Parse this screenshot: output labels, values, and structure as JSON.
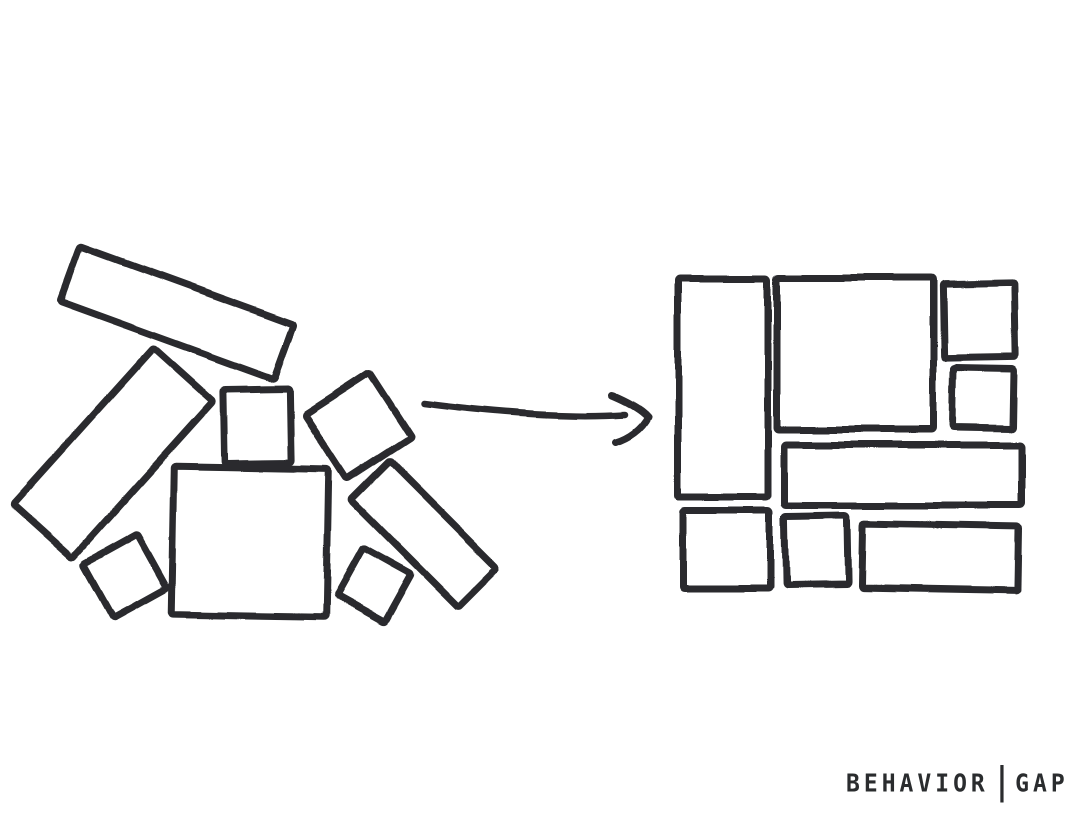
{
  "canvas": {
    "width": 1079,
    "height": 822,
    "background_color": "#ffffff",
    "ink_color": "#2a2c2e",
    "stroke_width": 7
  },
  "drawing": {
    "unorganized_pile": {
      "rectangles": [
        {
          "cx": 177,
          "cy": 313,
          "w": 228,
          "h": 58,
          "rot": 20
        },
        {
          "cx": 113,
          "cy": 453,
          "w": 210,
          "h": 80,
          "rot": -48
        },
        {
          "cx": 257,
          "cy": 426,
          "w": 66,
          "h": 74,
          "rot": -1
        },
        {
          "cx": 358,
          "cy": 426,
          "w": 77,
          "h": 77,
          "rot": -33
        },
        {
          "cx": 250,
          "cy": 542,
          "w": 155,
          "h": 148,
          "rot": 1
        },
        {
          "cx": 424,
          "cy": 534,
          "w": 152,
          "h": 55,
          "rot": 45
        },
        {
          "cx": 125,
          "cy": 576,
          "w": 61,
          "h": 61,
          "rot": -29
        },
        {
          "cx": 374,
          "cy": 585,
          "w": 55,
          "h": 55,
          "rot": 29
        }
      ]
    },
    "arrow": {
      "shaft_path": "M 424 403 C 486 411 564 418 625 414",
      "head_path": "M 612 395 C 631 403 643 411 648 417 C 642 429 629 438 616 442"
    },
    "organized_grid": {
      "rectangles": [
        {
          "cx": 723,
          "cy": 388,
          "w": 90,
          "h": 218,
          "rot": 0
        },
        {
          "cx": 855,
          "cy": 354,
          "w": 156,
          "h": 152,
          "rot": 0
        },
        {
          "cx": 979,
          "cy": 320,
          "w": 72,
          "h": 74,
          "rot": -1
        },
        {
          "cx": 983,
          "cy": 398,
          "w": 60,
          "h": 60,
          "rot": 1
        },
        {
          "cx": 903,
          "cy": 475,
          "w": 237,
          "h": 60,
          "rot": 0
        },
        {
          "cx": 726,
          "cy": 549,
          "w": 87,
          "h": 77,
          "rot": 0
        },
        {
          "cx": 816,
          "cy": 550,
          "w": 63,
          "h": 69,
          "rot": -1
        },
        {
          "cx": 940,
          "cy": 557,
          "w": 156,
          "h": 65,
          "rot": 1
        }
      ]
    }
  },
  "signature": {
    "brand_left": "BEHAVIOR",
    "separator": "|",
    "brand_right": "GAP"
  }
}
